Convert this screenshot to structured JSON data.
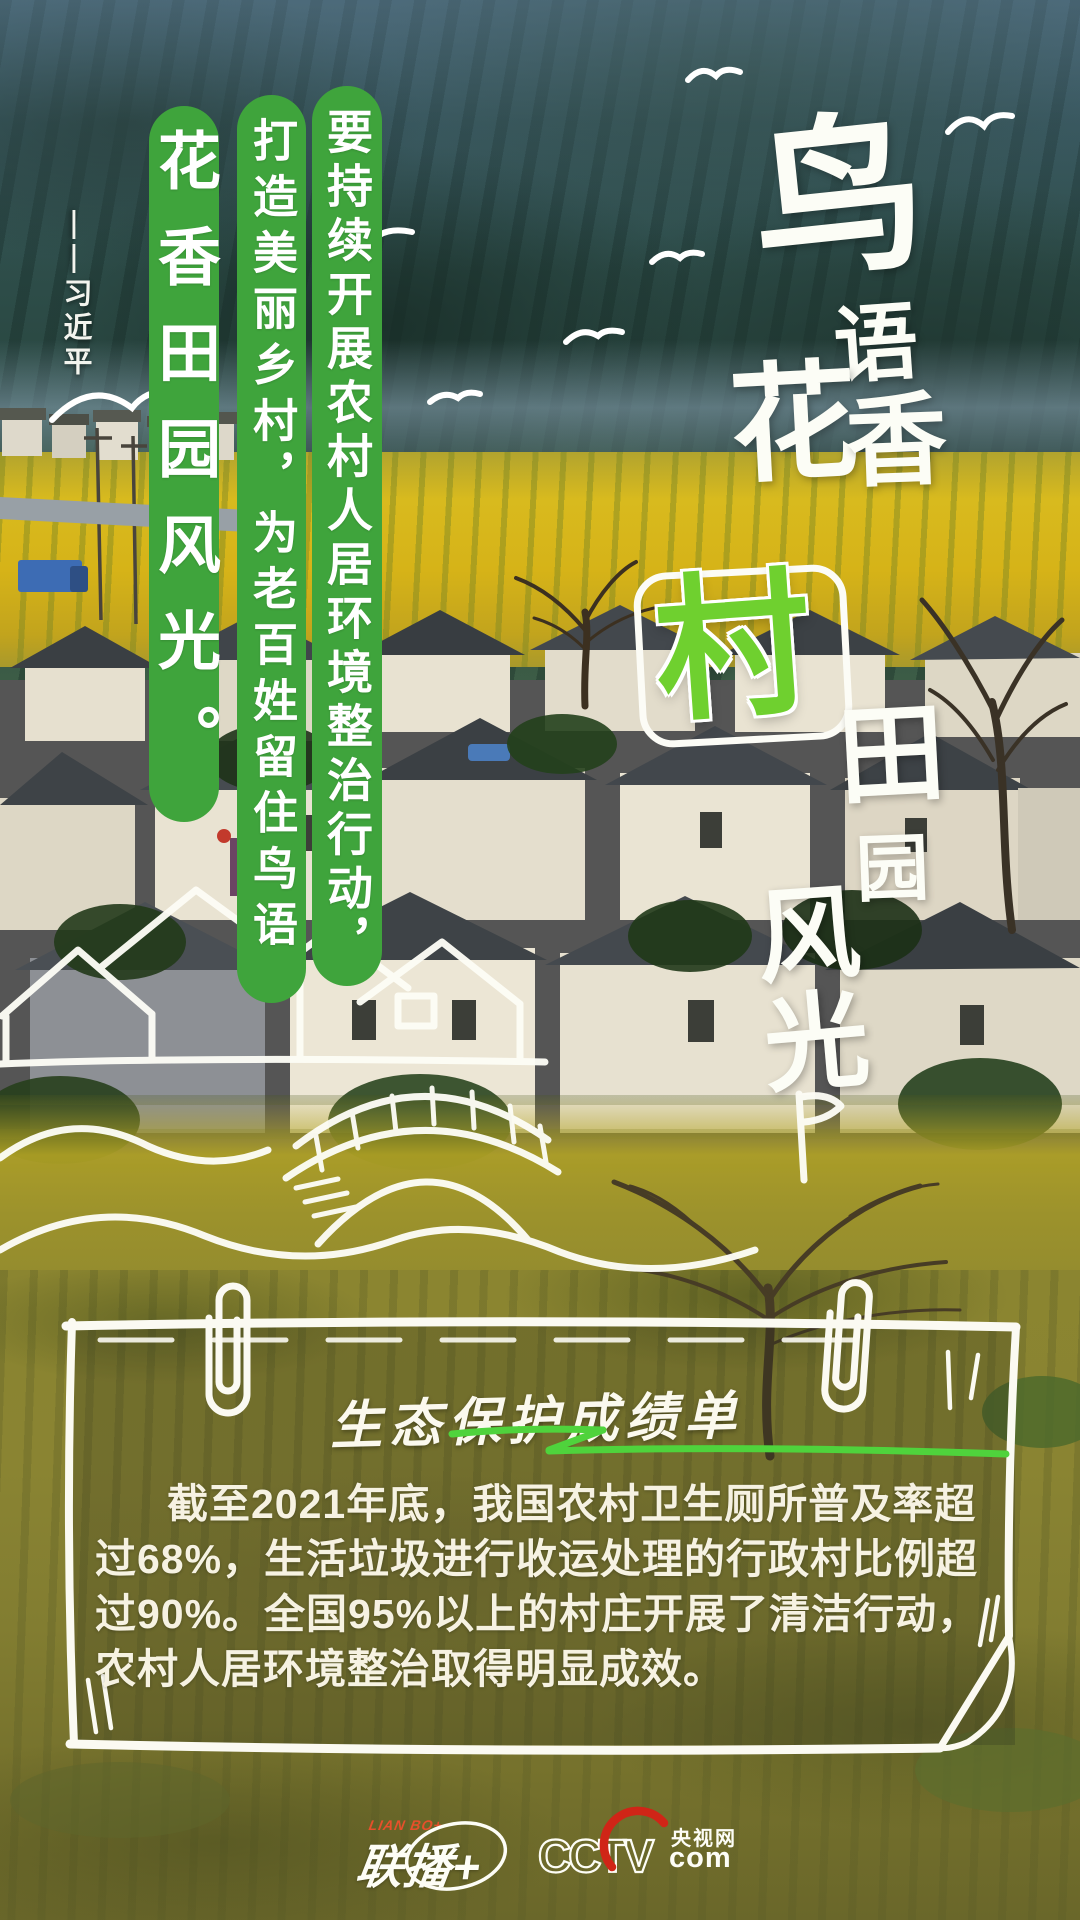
{
  "poster": {
    "headline": {
      "chars": [
        "鸟",
        "语",
        "花",
        "香",
        "村",
        "田",
        "园",
        "风",
        "光"
      ],
      "highlight_char": "村"
    },
    "quote": {
      "attribution": "——习近平",
      "line_1": "要持续开展农村人居环境整治行动，",
      "line_2": "打造美丽乡村，为老百姓留住鸟语",
      "line_3": "花香田园风光。"
    },
    "scorecard": {
      "title": "生态保护成绩单",
      "body_lines": [
        "截至2021年底，我国农村卫生厕所普及率超",
        "过68%，生活垃圾进行收运处理的行政村比例超",
        "过90%。全国95%以上的村庄开展了清洁行动，",
        "农村人居环境整治取得明显成效。"
      ]
    },
    "footer": {
      "lianbo_small": "LIAN BO+",
      "lianbo_main": "联播+",
      "cctv_letters": "CCTV",
      "cctv_site": "央视网",
      "cctv_domain": "com"
    },
    "colors": {
      "pill_green": "#3fa43c",
      "cun_green": "#6fd02f",
      "underline_green": "#4fd33c",
      "lianbo_red": "#e6502b",
      "cctv_red": "#d02517"
    }
  }
}
